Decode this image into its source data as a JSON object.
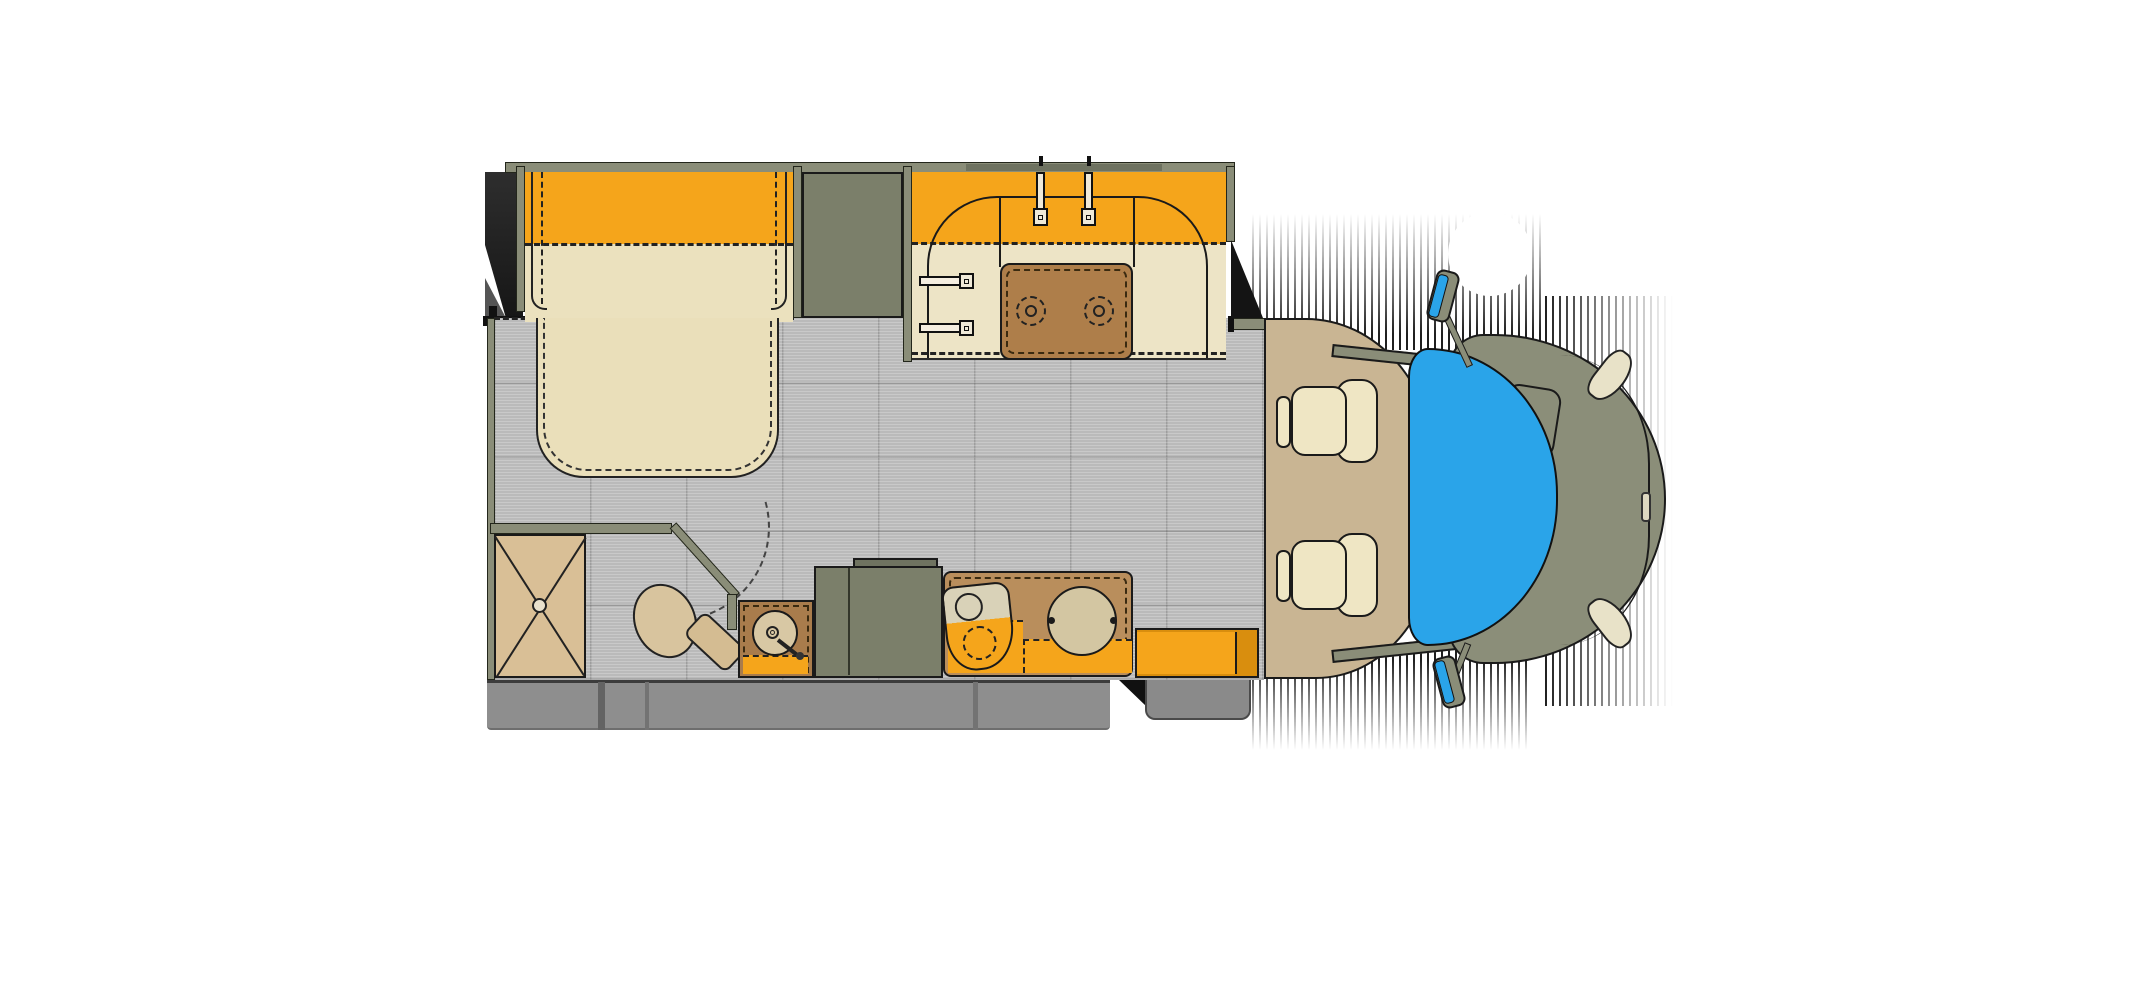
{
  "page": {
    "title": "RV Motorhome Floor Plan — Top View"
  },
  "floorplan": {
    "type": "class-c-motorhome-floorplan",
    "view": "top-down",
    "vehicle_front": "right",
    "colors": {
      "accent_orange": "#F5A51B",
      "accent_orange_dark": "#D98E0E",
      "bed_cream": "#EBE1BE",
      "counter_cream": "#EDE4C6",
      "cooktop_brown": "#AE7E4A",
      "counter_brown": "#B98E5C",
      "wall_olive": "#8A8D78",
      "cabinet_olive": "#7B7F6A",
      "floor_gray": "#BABABA",
      "cab_floor_tan": "#C9B593",
      "windshield_blue": "#2AA4E9",
      "hood_olive": "#8B8E79",
      "skirt_gray": "#8E8E8E",
      "fixture_tan": "#D9BF96",
      "seat_cream": "#EFE6C4",
      "shadow_black": "#1A1A1A"
    },
    "fixtures": {
      "slide_out": {
        "label": "Bedroom slide-out housing"
      },
      "bed": {
        "label": "Bed with overhead cabinet band"
      },
      "wardrobe": {
        "label": "Wardrobe cabinet"
      },
      "kitchen": {
        "label": "Kitchen counter with overhead cabinets"
      },
      "cooktop": {
        "label": "Two-burner cooktop",
        "burners": 2
      },
      "kitchen_drawers": {
        "label": "Kitchen drawer handles",
        "count": 2
      },
      "shower": {
        "label": "Shower stall with floor drain"
      },
      "toilet": {
        "label": "Toilet"
      },
      "bath_vanity": {
        "label": "Bathroom vanity with round sink"
      },
      "bath_door": {
        "label": "Bathroom door with swing arc"
      },
      "refrigerator": {
        "label": "Refrigerator and pantry cabinet"
      },
      "galley_sink": {
        "label": "Galley sink"
      },
      "table": {
        "label": "Round pedestal table"
      },
      "entry_step": {
        "label": "Entry step box"
      },
      "exterior_step": {
        "label": "Exterior entry step"
      },
      "skirt": {
        "label": "Lower body skirt"
      },
      "cab": {
        "label": "Cab floor"
      },
      "seat_driver": {
        "label": "Driver captain seat (swiveled)"
      },
      "seat_passenger": {
        "label": "Passenger captain seat (swiveled)"
      },
      "windshield": {
        "label": "Windshield"
      },
      "hood": {
        "label": "Engine hood"
      },
      "mirror_top": {
        "label": "Side mirror (driver side)"
      },
      "mirror_bottom": {
        "label": "Side mirror (passenger side)"
      },
      "headlights": {
        "label": "Headlights",
        "count": 2
      }
    },
    "counts": {
      "cab_seats": 2,
      "cooktop_burners": 2,
      "sinks": 2,
      "doors": 1
    }
  }
}
